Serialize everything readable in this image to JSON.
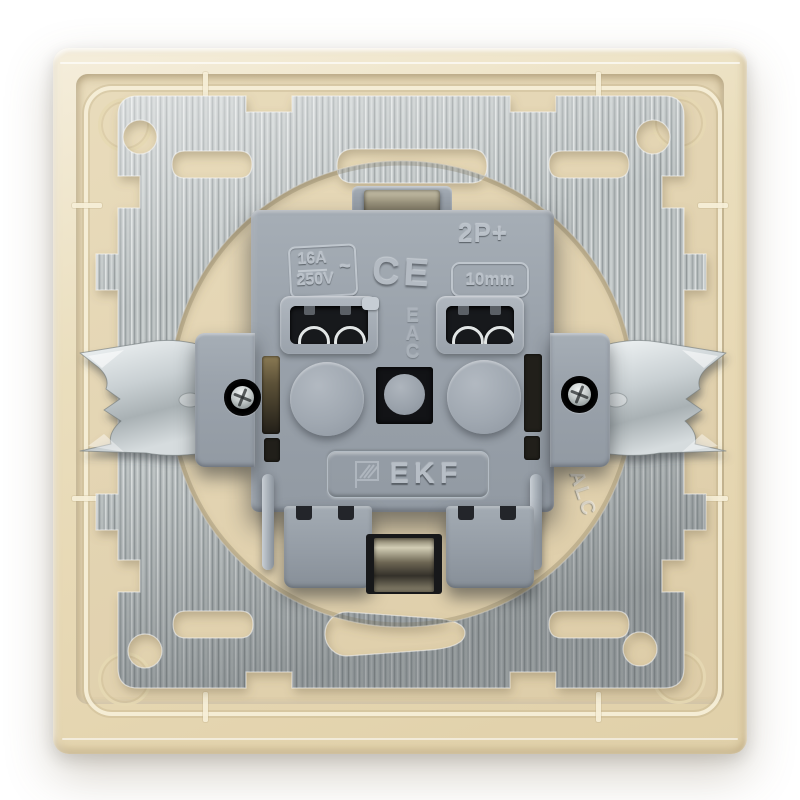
{
  "image": {
    "kind": "product-photo",
    "subject": "Back view of EKF flush-mounted socket mechanism with claws, steel support plate and beige frame",
    "background_color": "#ffffff"
  },
  "colors": {
    "frame_beige": "#ead9b8",
    "panel_beige": "#e3d4b2",
    "metal_silver": "#b4babb",
    "plastic_gray": "#9aa2ab",
    "marking_gray": "#bac1c9",
    "terminal_dark": "#17191c",
    "claw_zinc": "#d7dde0"
  },
  "markings": {
    "ratings": {
      "current": "16A",
      "voltage": "250V",
      "ac_symbol": "~"
    },
    "ce_mark": "CE",
    "poles_label": "2P+",
    "wire_strip_label": "10mm",
    "eac_mark": "EAC",
    "brand": "EKF",
    "metal_stamp": "ALC"
  },
  "icons": {
    "ekf_flag_icon": "ekf-flag-icon"
  }
}
